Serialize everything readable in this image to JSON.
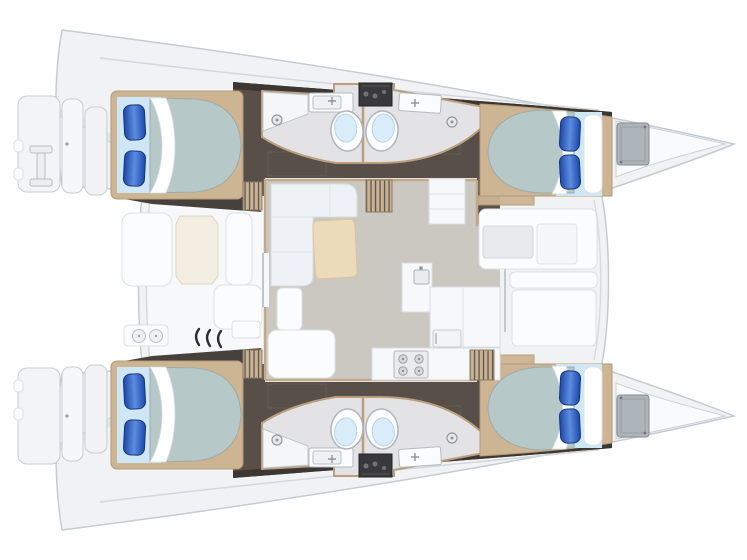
{
  "meta": {
    "title": "Catamaran yacht floor plan - overhead deck view",
    "orientation": "bows to the right, sterns with swim platforms to the left",
    "cabin_count": 4,
    "head_count": 4
  },
  "vessel": {
    "type": "sailing catamaran",
    "layout_summary": "4 double cabins, 4 heads, bridgedeck salon with galley, aft cockpit with dining, forward cockpit lounge",
    "port_hull": {
      "name": "port hull (top)",
      "features": [
        "swim platform and transom steps",
        "boarding ladder fitting",
        "aft double cabin with two blue pillows",
        "two back-to-back heads each with toilet, sink and shower drain",
        "dark appliance unit between head vanities",
        "forward double cabin with white and blue pillows",
        "bow storage hatch"
      ]
    },
    "starboard_hull": {
      "name": "starboard hull (bottom)",
      "features": [
        "swim platform and transom steps",
        "aft double cabin with two blue pillows",
        "two back-to-back heads each with toilet, sink and shower drain",
        "dark appliance unit between head vanities",
        "forward double cabin with white and blue pillows",
        "bow storage hatch"
      ]
    },
    "aft_cockpit": {
      "features": [
        "L-bench seating",
        "octagonal cockpit table",
        "side bench",
        "wet bar with twin round sinks",
        "three companionway arc marks",
        "storage locker"
      ]
    },
    "salon": {
      "features": [
        "L-shaped sofa",
        "wood coffee table",
        "nav seat",
        "aft bench",
        "tall cabinet",
        "galley counter with square sink",
        "refrigerator door",
        "four-burner stove",
        "companionway steps down to each hull"
      ]
    },
    "forward_cockpit": {
      "features": [
        "lounge seat with recessed footwell",
        "seat back band",
        "large sun pad",
        "curved crossbeam edge"
      ]
    }
  },
  "colors": {
    "deck": "#f1f2f4",
    "hull_outline": "#c6cbd1",
    "interior_floor": "#574f48",
    "interior_floor_band": "#3c3733",
    "wood_trim": "#cdb493",
    "wood_step": "#c9b294",
    "bed_mattress": "#b6c8c7",
    "bed_sheet": "#cfe7f5",
    "pillow_dark": "#1d48a8",
    "pillow_light": "#5c8de0",
    "bath_floor": "#e3e3e5",
    "toilet_bowl": "#d8edf9",
    "salon_floor": "#cbc7c1",
    "salon_table": "#ecdbbb",
    "cockpit_table": "#f3eee1",
    "counter": "#f6f8fa",
    "furniture_white": "#fbfcfd",
    "sofa": "#eef2f6",
    "hatch_gray": "#adb4ba",
    "appliance_dark": "#39393c",
    "step_line_dark": "#5f564d"
  }
}
